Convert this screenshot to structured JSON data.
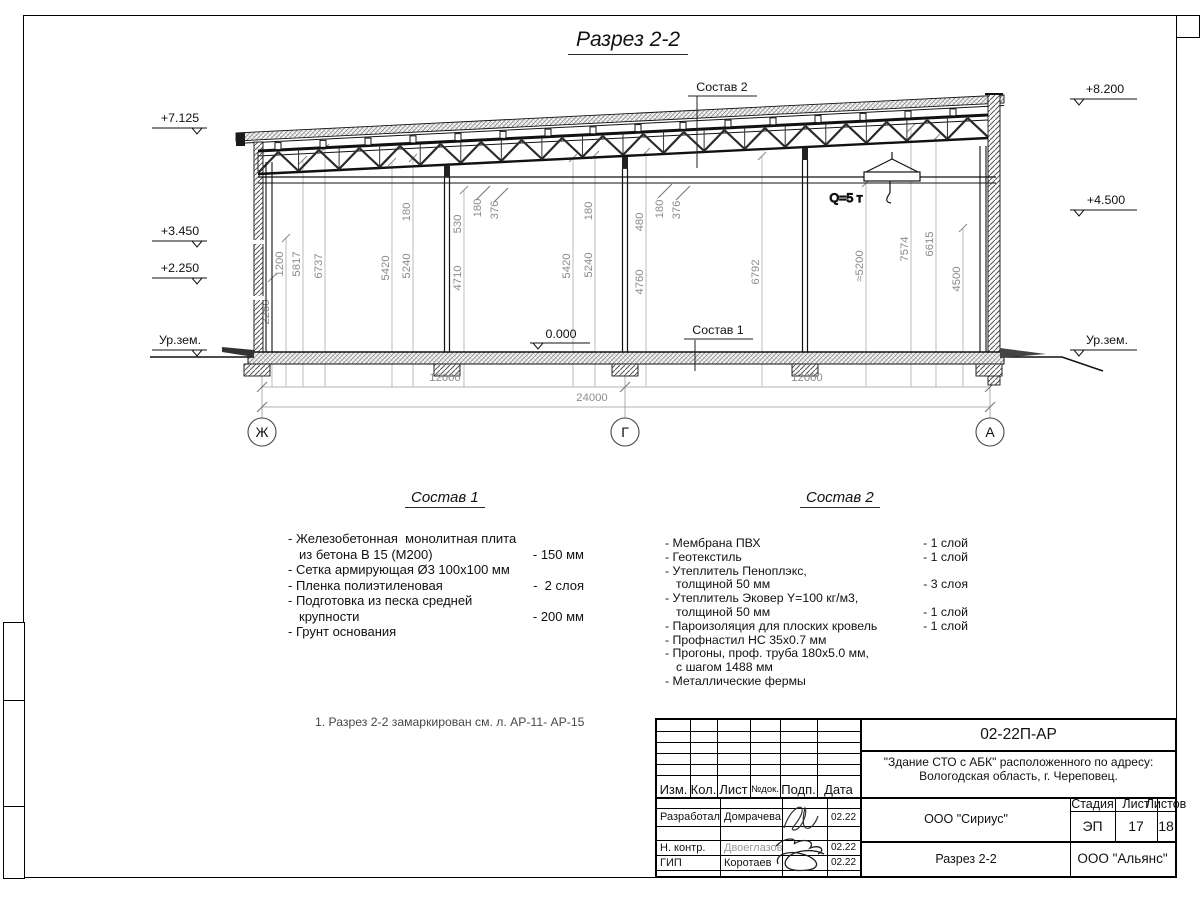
{
  "page_title": "Разрез 2-2",
  "drawing": {
    "labels": {
      "sostav1": "Состав 1",
      "sostav2": "Состав 2",
      "zero": "0.000",
      "crane": "Q=5 т"
    },
    "elev_left": [
      "+7.125",
      "+3.450",
      "+2.250",
      "Ур.зем."
    ],
    "elev_right": [
      "+8.200",
      "+4.500",
      "Ур.зем."
    ],
    "axes": [
      "Ж",
      "Г",
      "А"
    ],
    "hdims": {
      "left": "12000",
      "right": "12000",
      "total": "24000"
    },
    "vdims": [
      "2250",
      "1200",
      "5817",
      "6737",
      "5420",
      "5240",
      "180",
      "530",
      "4710",
      "180",
      "376",
      "5420",
      "180",
      "5240",
      "480",
      "4760",
      "180",
      "376",
      "6792",
      "≈5200",
      "7574",
      "6615",
      "4500"
    ],
    "colors": {
      "dimension_text": "#8c8c8c",
      "structure_line": "#111111"
    }
  },
  "sostav1": {
    "title": "Состав 1",
    "lines": [
      {
        "t": "- Железобетонная  монолитная плита",
        "v": ""
      },
      {
        "t": "из бетона В 15 (М200)",
        "v": "- 150 мм",
        "cont": true
      },
      {
        "t": "- Сетка армирующая Ø3 100х100 мм",
        "v": ""
      },
      {
        "t": "- Пленка полиэтиленовая",
        "v": "-  2 слоя"
      },
      {
        "t": "- Подготовка из песка средней",
        "v": ""
      },
      {
        "t": "крупности",
        "v": "- 200 мм",
        "cont": true
      },
      {
        "t": "- Грунт основания",
        "v": ""
      }
    ]
  },
  "sostav2": {
    "title": "Состав 2",
    "lines": [
      {
        "t": "- Мембрана ПВХ",
        "v": "- 1 слой"
      },
      {
        "t": "- Геотекстиль",
        "v": "- 1 слой"
      },
      {
        "t": "- Утеплитель Пеноплэкс,",
        "v": ""
      },
      {
        "t": "толщиной 50 мм",
        "v": "- 3 слоя",
        "cont": true
      },
      {
        "t": "- Утеплитель Эковер Y=100 кг/м3,",
        "v": ""
      },
      {
        "t": "толщиной 50 мм",
        "v": "- 1 слой",
        "cont": true
      },
      {
        "t": "- Пароизоляция для плоских кровель",
        "v": "- 1 слой"
      },
      {
        "t": "- Профнастил НС 35х0.7 мм",
        "v": ""
      },
      {
        "t": "- Прогоны, проф. труба 180х5.0 мм,",
        "v": ""
      },
      {
        "t": "с шагом 1488 мм",
        "v": "",
        "cont": true
      },
      {
        "t": "- Металлические фермы",
        "v": ""
      }
    ]
  },
  "note": "1. Разрез 2-2 замаркирован см. л. АР-11- АР-15",
  "titleblock": {
    "doc_number": "02-22П-АР",
    "project_line1": "\"Здание СТО с АБК\" расположенного по адресу:",
    "project_line2": "Вологодская область, г. Череповец.",
    "header_cols": [
      "Изм.",
      "Кол.",
      "Лист",
      "№док.",
      "Подп.",
      "Дата"
    ],
    "rows": [
      {
        "role": "Разработал",
        "name": "Домрачева",
        "date": "02.22"
      },
      {
        "role": "Н. контр.",
        "name": "Двоеглазов",
        "date": "02.22"
      },
      {
        "role": "ГИП",
        "name": "Коротаев",
        "date": "02.22"
      }
    ],
    "org_design": "ООО \"Сириус\"",
    "org_customer": "ООО \"Альянс\"",
    "stage_label": "Стадия",
    "sheet_label": "Лист",
    "sheets_label": "Листов",
    "stage": "ЭП",
    "sheet": "17",
    "sheets": "18",
    "drawing_name": "Разрез 2-2"
  }
}
